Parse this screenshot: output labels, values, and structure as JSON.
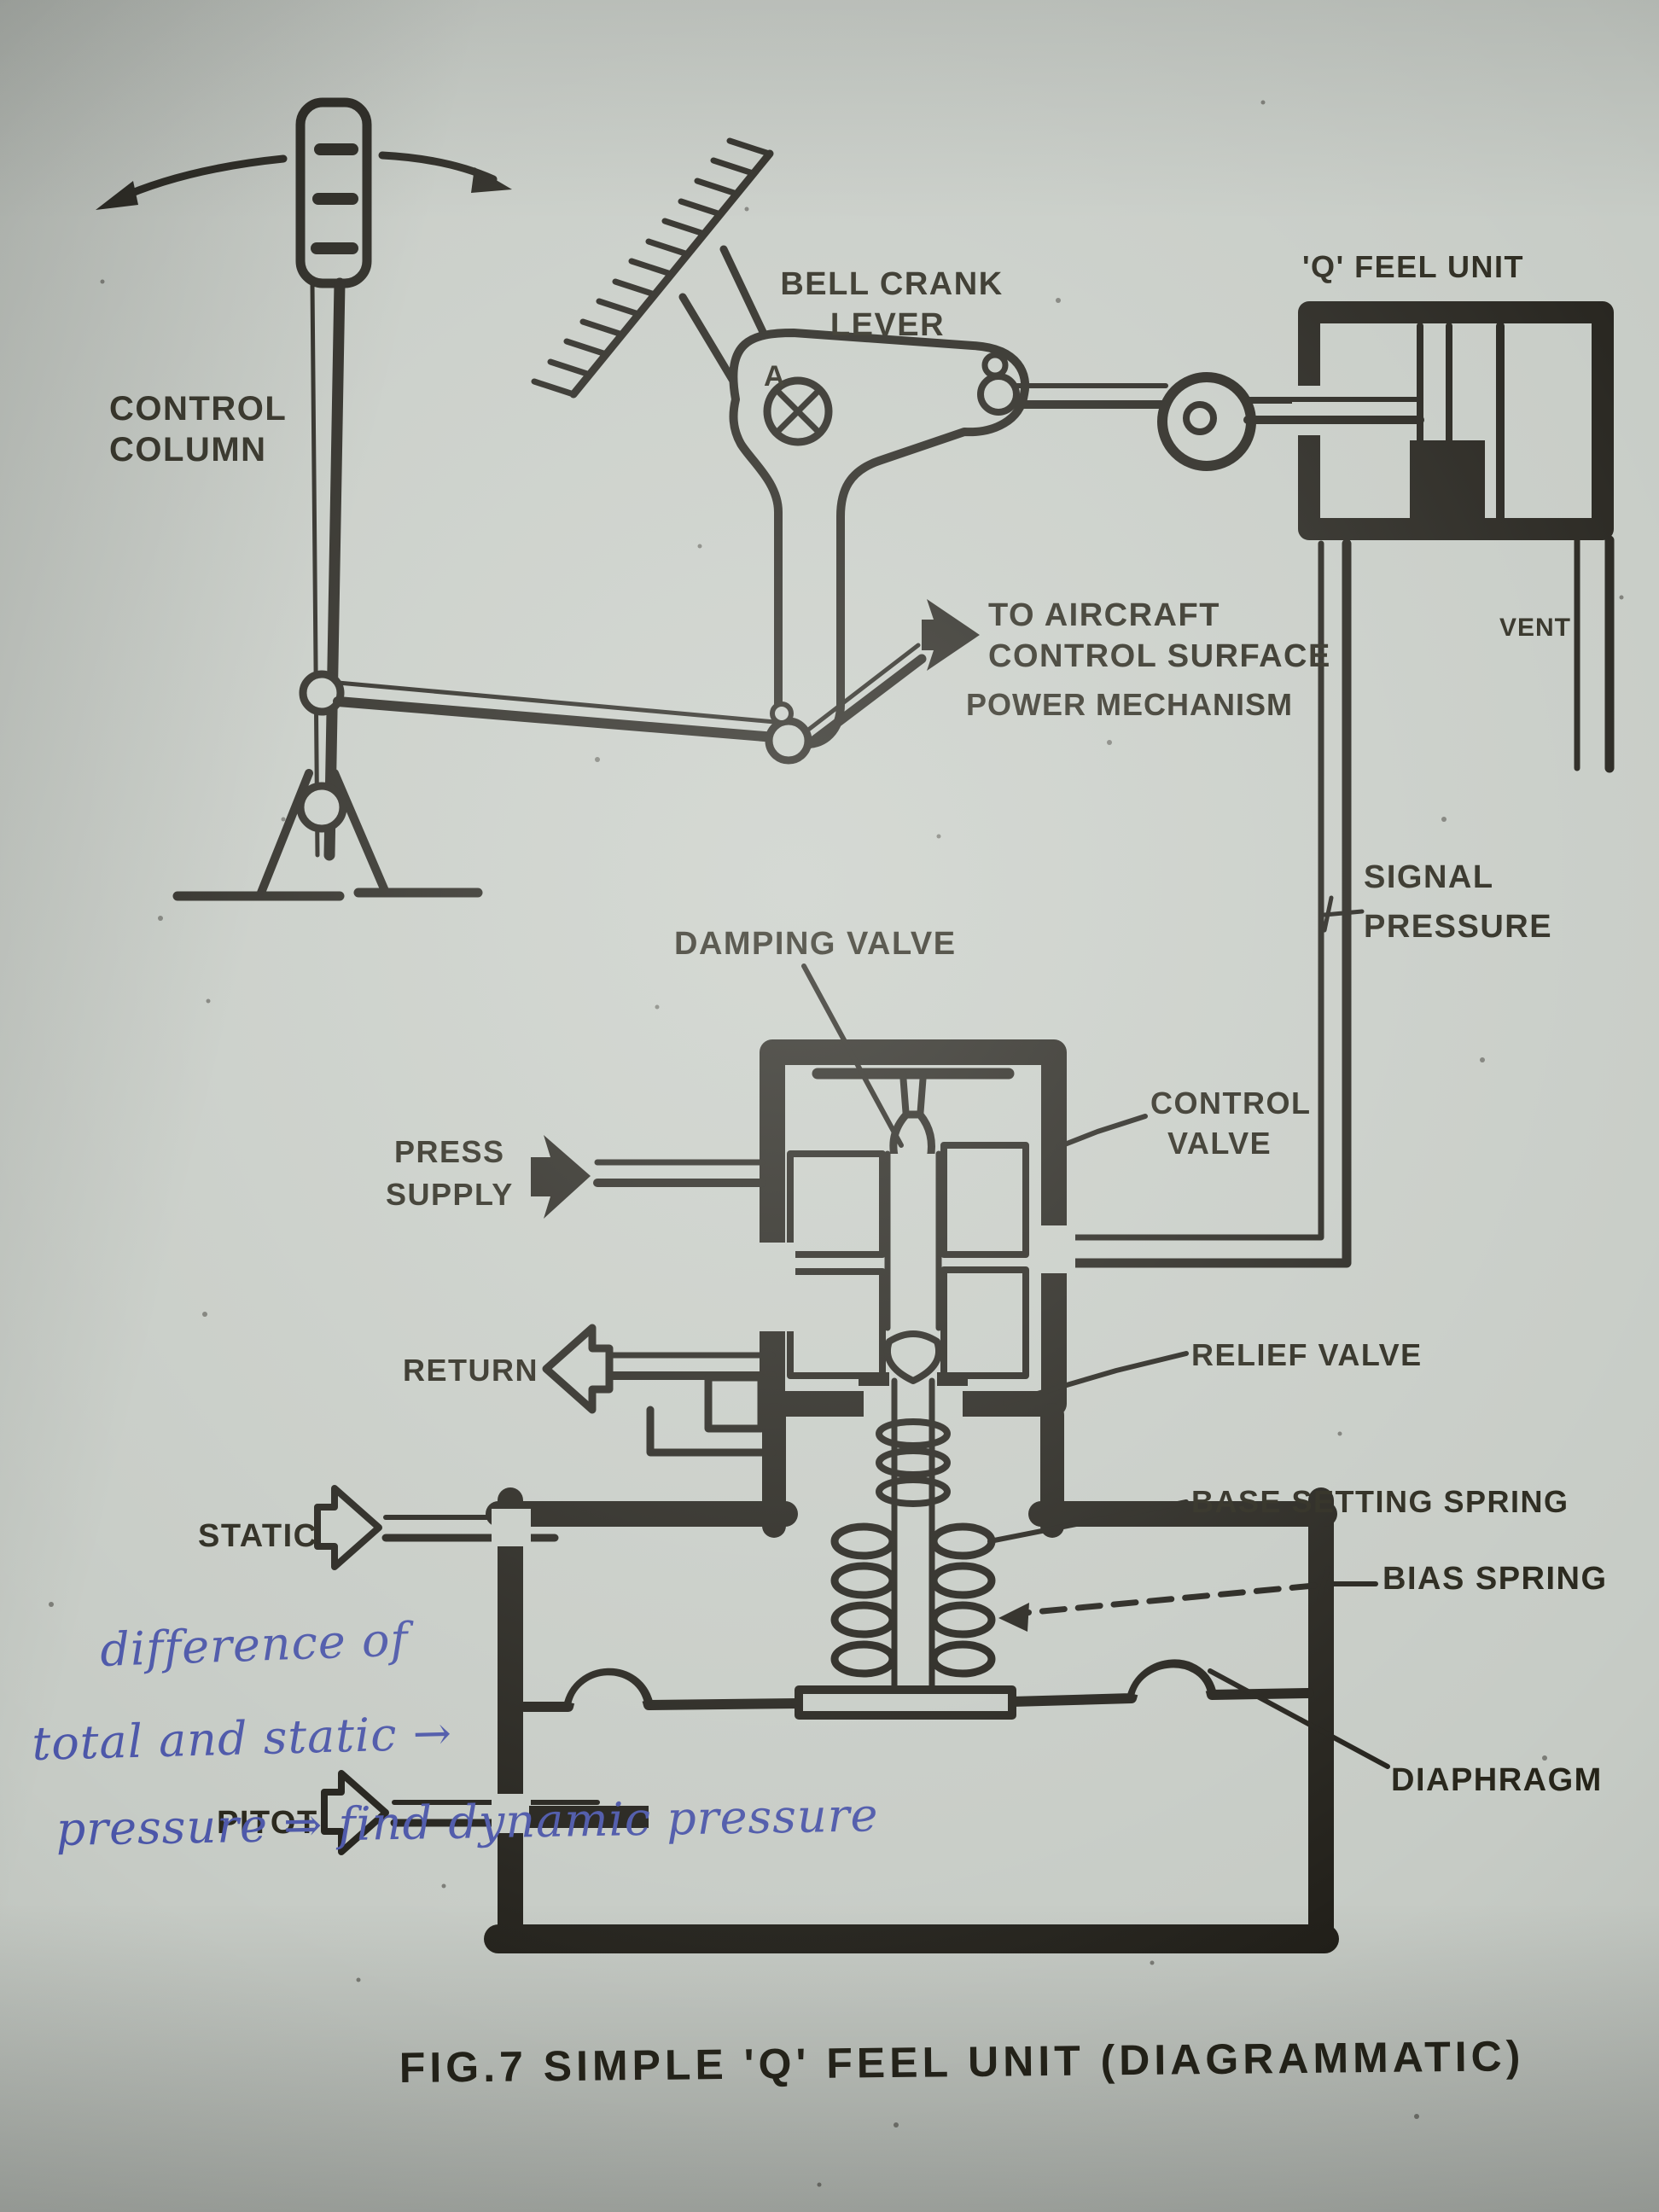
{
  "figure": {
    "caption": "FIG.7 SIMPLE 'Q' FEEL UNIT (DIAGRAMMATIC)"
  },
  "diagram": {
    "colors": {
      "ink": "#211f19",
      "paper": "#c6cbc5",
      "handwriting_ink": "#4a55a8"
    },
    "labels": {
      "control_column_line1": "CONTROL",
      "control_column_line2": "COLUMN",
      "bell_crank_line1": "BELL CRANK",
      "bell_crank_line2": "LEVER",
      "pivot_a": "A",
      "q_feel_unit": "'Q' FEEL UNIT",
      "vent": "VENT",
      "signal_line1": "SIGNAL",
      "signal_line2": "PRESSURE",
      "to_surface_line1": "TO AIRCRAFT",
      "to_surface_line2": "CONTROL SURFACE",
      "to_surface_line3": "POWER MECHANISM",
      "damping_valve": "DAMPING VALVE",
      "control_valve_line1": "CONTROL",
      "control_valve_line2": "VALVE",
      "press_supply_line1": "PRESS",
      "press_supply_line2": "SUPPLY",
      "return": "RETURN",
      "relief_valve": "RELIEF VALVE",
      "base_setting_spring": "BASE SETTING SPRING",
      "static": "STATIC",
      "bias_spring": "BIAS SPRING",
      "diaphragm": "DIAPHRAGM",
      "pitot": "PITOT"
    },
    "handwritten_note": {
      "line1": "difference of",
      "line2": "total and static →",
      "line3": "pressure ⇒ find dynamic pressure"
    }
  }
}
